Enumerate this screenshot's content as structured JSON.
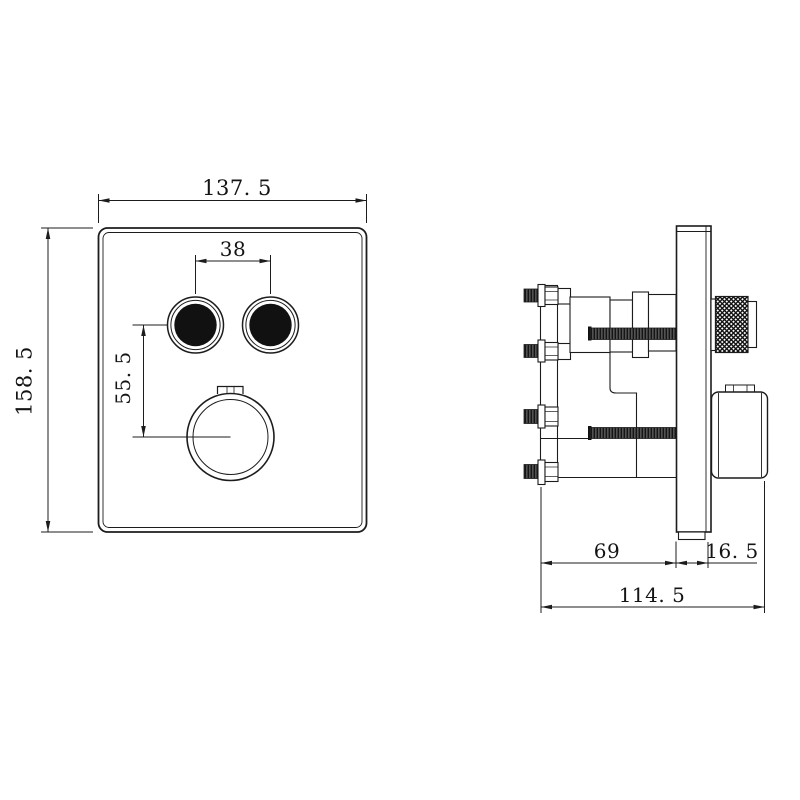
{
  "front": {
    "width": "137. 5",
    "height": "158. 5",
    "button_spacing": "38",
    "button_to_knob": "55. 5"
  },
  "side": {
    "body_depth": "69",
    "plate_thickness": "16. 5",
    "overall_depth": "114. 5"
  },
  "colors": {
    "line": "#1c1c1c",
    "fill_black": "#111111",
    "background": "#ffffff"
  }
}
